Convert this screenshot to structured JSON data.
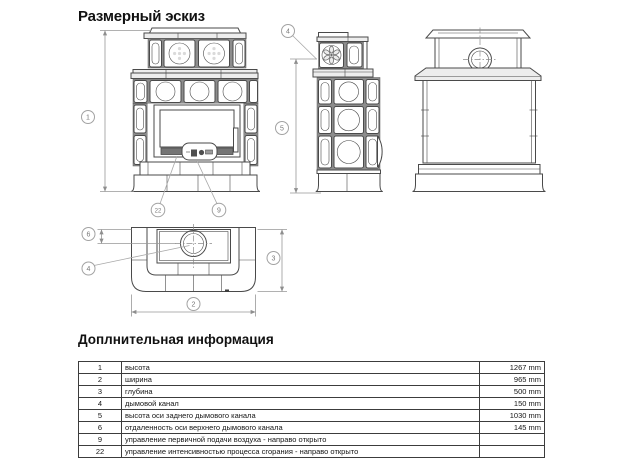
{
  "page": {
    "title": "Размерный эскиз"
  },
  "drawing": {
    "callouts": {
      "c1": "1",
      "c2": "2",
      "c3": "3",
      "c4": "4",
      "c5": "5",
      "c6": "6",
      "c9": "9",
      "c22": "22"
    }
  },
  "info": {
    "title": "Доплнительная информация",
    "rows": [
      {
        "num": "1",
        "desc": "высота",
        "value": "1267 mm"
      },
      {
        "num": "2",
        "desc": "ширина",
        "value": "965 mm"
      },
      {
        "num": "3",
        "desc": "глубина",
        "value": "500 mm"
      },
      {
        "num": "4",
        "desc": "дымовой канал",
        "value": "150 mm"
      },
      {
        "num": "5",
        "desc": "высота оси заднего дымового канала",
        "value": "1030 mm"
      },
      {
        "num": "6",
        "desc": "отдаленность оси верхнего дымового канала",
        "value": "145 mm"
      },
      {
        "num": "9",
        "desc": "управление первичной подачи воздуха - направо открыто",
        "value": ""
      },
      {
        "num": "22",
        "desc": "управление интенсивностью процесса сгорания - направо открыто",
        "value": ""
      }
    ]
  }
}
